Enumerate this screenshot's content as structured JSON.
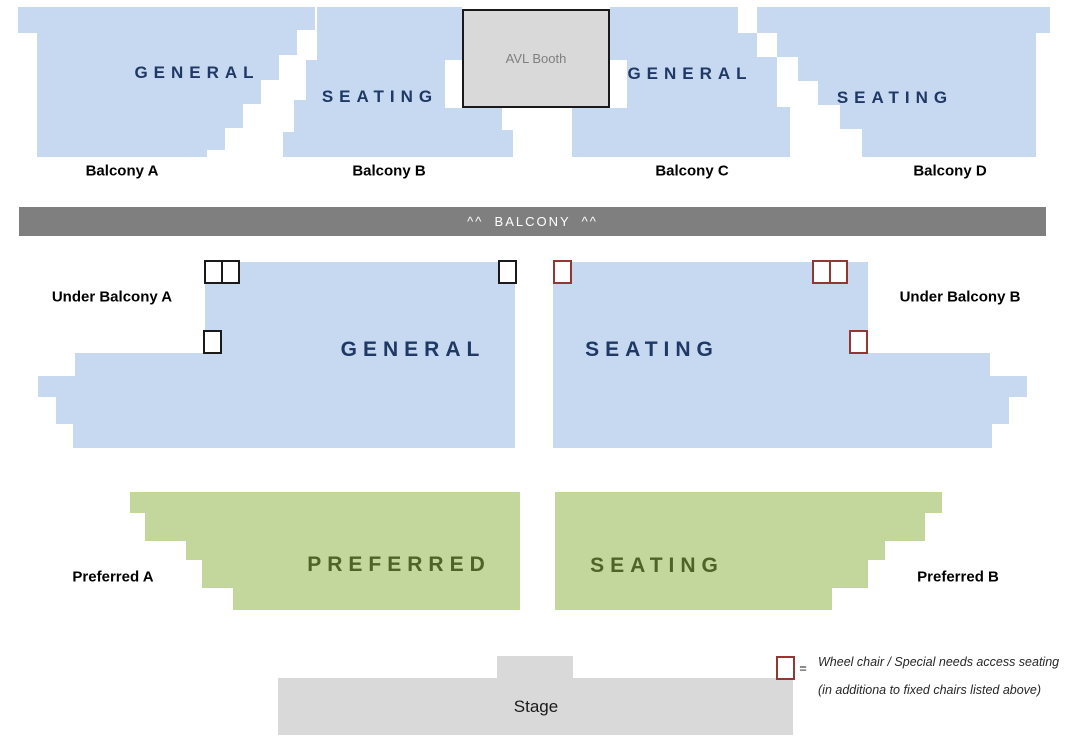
{
  "balconies": {
    "a": {
      "heading": "GENERAL",
      "label": "Balcony A"
    },
    "b": {
      "heading": "SEATING",
      "label": "Balcony B"
    },
    "c": {
      "heading": "GENERAL",
      "label": "Balcony C"
    },
    "d": {
      "heading": "SEATING",
      "label": "Balcony D"
    }
  },
  "avl_booth": {
    "label": "AVL Booth"
  },
  "balcony_bar": {
    "label": "^^  BALCONY  ^^"
  },
  "main_floor": {
    "left": {
      "heading": "GENERAL",
      "label": "Under Balcony A"
    },
    "right": {
      "heading": "SEATING",
      "label": "Under Balcony B"
    }
  },
  "preferred": {
    "left": {
      "heading": "PREFERRED",
      "label": "Preferred A"
    },
    "right": {
      "heading": "SEATING",
      "label": "Preferred B"
    }
  },
  "stage": {
    "label": "Stage"
  },
  "legend": {
    "symbol_equals": "=",
    "line1": "Wheel chair / Special needs access seating",
    "line2": "(in additiona to fixed chairs listed above)"
  },
  "colors": {
    "section_blue": "#C6D9F1",
    "section_green": "#C3D69B",
    "heading_navy": "#1F3864",
    "heading_green": "#4F6228",
    "bar_gray": "#7F7F7F",
    "stage_gray": "#D9D9D9",
    "booth_text_gray": "#7F7F7F",
    "wheelchair_border_black": "#1a1a1a",
    "wheelchair_border_maroon": "#943634"
  }
}
